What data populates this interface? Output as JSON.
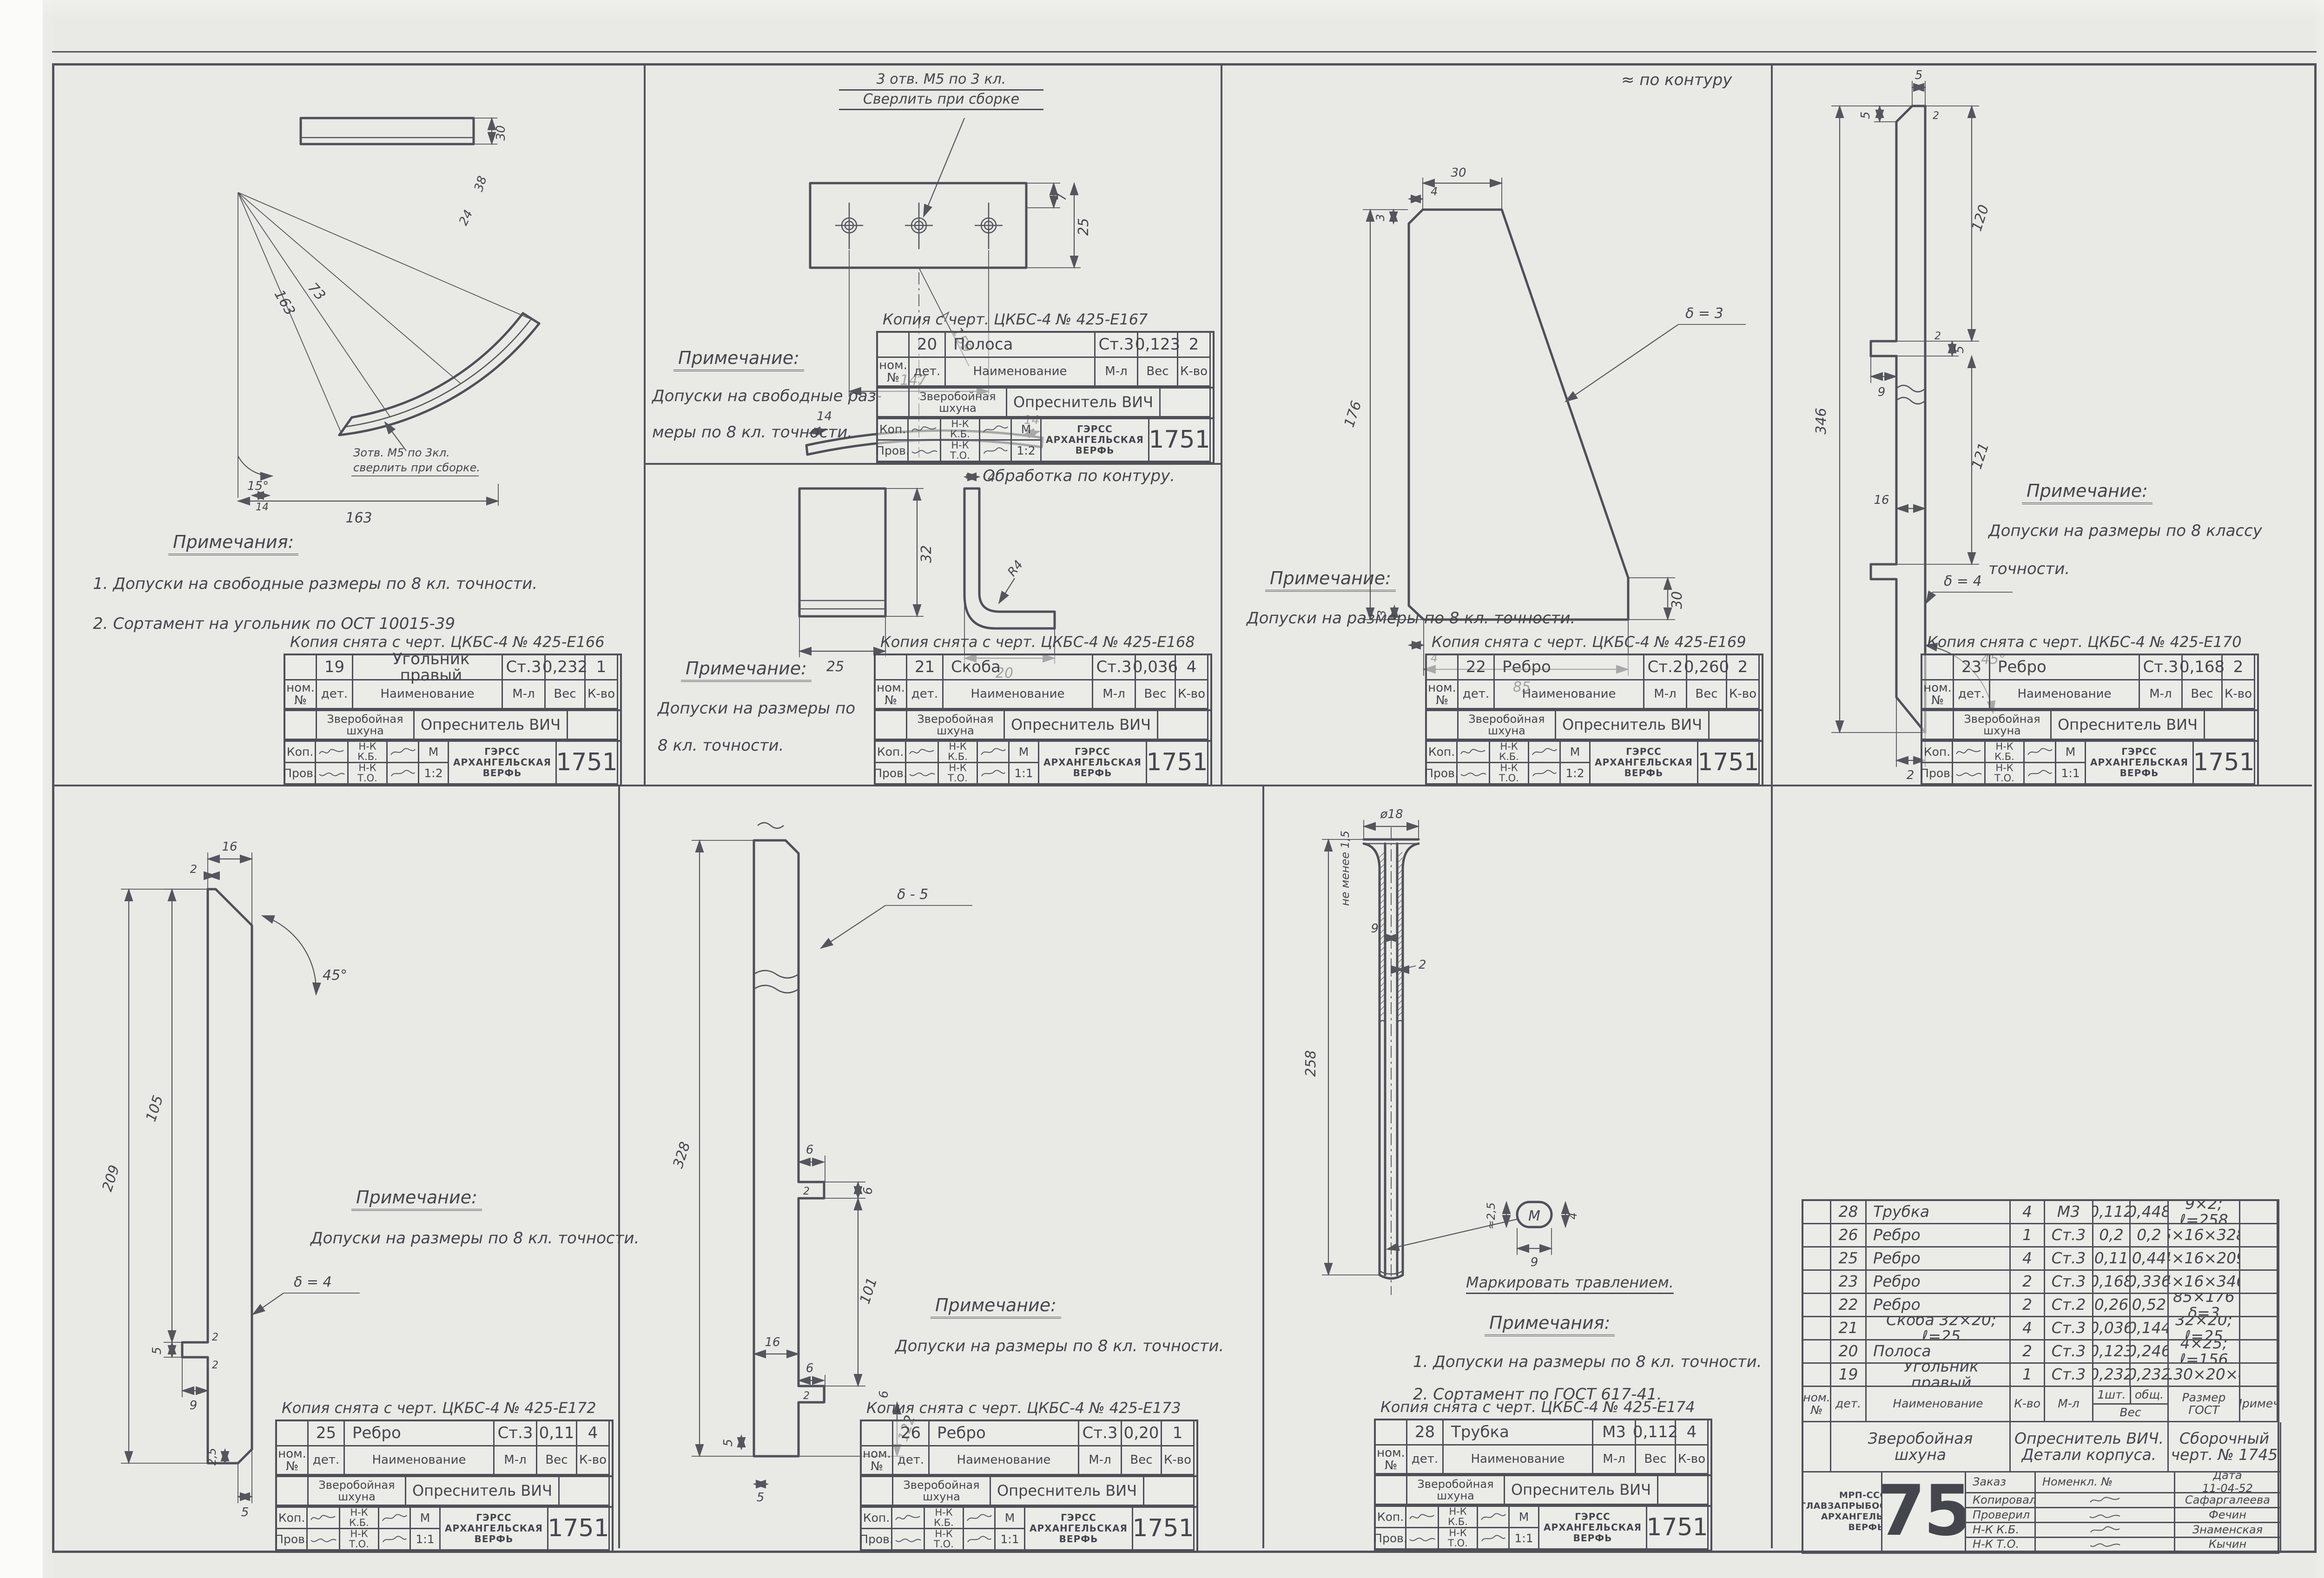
{
  "sheet": {
    "number": "1751",
    "contour_note_p22": "≈ по контуру",
    "contour_note_p20": "≈ Обработка по контуру."
  },
  "colors": {
    "paper": "#e9e9e6",
    "ink": "#4f5057"
  },
  "tb": {
    "nom": "ном.\n№",
    "det": "дет.",
    "name": "Наименование",
    "mat": "М-л",
    "weight": "Вес",
    "qty": "К-во",
    "project": "Зверобойная\nшхуна",
    "object": "Опреснитель ВИЧ",
    "kop": "Коп.",
    "prov": "Пров.",
    "nkkb": "Н-К\nК.Б.",
    "nkto": "Н-К\nТ.О.",
    "m": "М",
    "f1": "ГЭРСС",
    "f2": "АРХАНГЕЛЬСКАЯ",
    "f3": "ВЕРФЬ",
    "num": "1751"
  },
  "panels": {
    "p19": {
      "copy": "Копия снята с черт. ЦКБС-4 № 425-Е166",
      "num": "19",
      "name": "Угольник правый",
      "mat": "Ст.3",
      "weight": "0,232",
      "qty": "1",
      "scale": "1:2",
      "note_title": "Примечания:",
      "l1": "1. Допуски на свободные размеры  по 8 кл. точности.",
      "l2": "2. Сортамент на угольник  по ОСТ 10015-39",
      "labels": {
        "note1": "Зотв. М5 по 3кл.",
        "note2": "сверлить при сборке."
      },
      "dims": [
        "30",
        "38",
        "24",
        "163",
        "73",
        "15°",
        "163",
        "14"
      ]
    },
    "p20": {
      "copy": "Копия с черт. ЦКБС-4 № 425-Е167",
      "num": "20",
      "name": "Полоса",
      "mat": "Ст.3",
      "weight": "0,123",
      "qty": "2",
      "scale": "1:2",
      "note_title": "Примечание:",
      "l1": "Допуски на свободные раз-",
      "l2": "меры  по 8 кл. точности.",
      "labels": {
        "drill1": "3 отв. М5 по 3 кл.",
        "drill2": "Сверлить при сборке"
      },
      "dims": [
        "7",
        "25",
        "159",
        "147",
        "14",
        "14"
      ]
    },
    "p21": {
      "copy": "Копия снята с черт. ЦКБС-4 № 425-Е168",
      "num": "21",
      "name": "Скоба",
      "mat": "Ст.3",
      "weight": "0,036",
      "qty": "4",
      "scale": "1:1",
      "note_title": "Примечание:",
      "l1": "Допуски на размеры по",
      "l2": "8 кл. точности.",
      "dims": [
        "32",
        "25",
        "4",
        "R4",
        "20"
      ]
    },
    "p22": {
      "copy": "Копия снята с черт. ЦКБС-4 № 425-Е169",
      "num": "22",
      "name": "Ребро",
      "mat": "Ст.2",
      "weight": "0,260",
      "qty": "2",
      "scale": "1:2",
      "note_title": "Примечание:",
      "l1": "Допуски на размеры по 8 кл. точности.",
      "labels": {
        "delta": "δ = 3"
      },
      "dims": [
        "30",
        "4",
        "3",
        "176",
        "30",
        "85",
        "4",
        "3"
      ]
    },
    "p23": {
      "copy": "Копия снята с черт. ЦКБС-4 № 425-Е170",
      "num": "23",
      "name": "Ребро",
      "mat": "Ст.3",
      "weight": "0,168",
      "qty": "2",
      "scale": "1:1",
      "note_title": "Примечание:",
      "l1": "Допуски на размеры по 8 классу",
      "l2": "точности.",
      "labels": {
        "delta": "δ = 4"
      },
      "dims": [
        "5",
        "5",
        "2",
        "120",
        "346",
        "9",
        "5",
        "121",
        "16",
        "45°",
        "2"
      ]
    },
    "p25": {
      "copy": "Копия снята с черт. ЦКБС-4 № 425-Е172",
      "num": "25",
      "name": "Ребро",
      "mat": "Ст.3",
      "weight": "0,11",
      "qty": "4",
      "scale": "1:1",
      "note_title": "Примечание:",
      "l1": "Допуски на размеры по 8 кл. точности.",
      "labels": {
        "delta": "δ = 4"
      },
      "dims": [
        "16",
        "2",
        "45°",
        "105",
        "209",
        "5",
        "9",
        "2,5",
        "5",
        "2",
        "2"
      ]
    },
    "p26": {
      "copy": "Копия снята с черт. ЦКБС-4 № 425-Е173",
      "num": "26",
      "name": "Ребро",
      "mat": "Ст.3",
      "weight": "0,20",
      "qty": "1",
      "scale": "1:1",
      "note_title": "Примечание:",
      "l1": "Допуски на размеры по 8 кл. точности.",
      "labels": {
        "delta": "δ - 5"
      },
      "dims": [
        "6",
        "2",
        "6",
        "16",
        "101",
        "6",
        "2",
        "6",
        "122",
        "5",
        "5",
        "328"
      ]
    },
    "p28": {
      "copy": "Копия снята с черт. ЦКБС-4 № 425-Е174",
      "num": "28",
      "name": "Трубка",
      "mat": "М3",
      "weight": "0,112",
      "qty": "4",
      "scale": "1:1",
      "note_title": "Примечания:",
      "l1": "1. Допуски на размеры по 8 кл. точности.",
      "l2": "2. Сортамент  по ГОСТ 617-41.",
      "labels": {
        "min": "не менее 1,5",
        "mark": "М",
        "etch": "Маркировать травлением."
      },
      "dims": [
        "ø18",
        "9",
        "2",
        "258",
        "≈2,5",
        "4",
        "9"
      ]
    }
  },
  "parts_table": {
    "header": {
      "nom": "ном.\n№",
      "det": "дет.",
      "name": "Наименование",
      "qty": "К-во",
      "mat": "М-л",
      "w1": "1шт.",
      "w2": "общ.",
      "wshared": "Вес",
      "size": "Размер\nГОСТ",
      "note": "Примеч."
    },
    "rows": [
      {
        "num": "28",
        "name": "Трубка",
        "qty": "4",
        "mat": "М3",
        "w1": "0,112",
        "w2": "0,448",
        "size": "9×2; ℓ=258",
        "note": ""
      },
      {
        "num": "26",
        "name": "Ребро",
        "qty": "1",
        "mat": "Ст.3",
        "w1": "0,2",
        "w2": "0,2",
        "size": "5×16×328",
        "note": ""
      },
      {
        "num": "25",
        "name": "Ребро",
        "qty": "4",
        "mat": "Ст.3",
        "w1": "0,11",
        "w2": "0,44",
        "size": "4×16×209",
        "note": ""
      },
      {
        "num": "23",
        "name": "Ребро",
        "qty": "2",
        "mat": "Ст.3",
        "w1": "0,168",
        "w2": "0,336",
        "size": "4×16×346",
        "note": ""
      },
      {
        "num": "22",
        "name": "Ребро",
        "qty": "2",
        "mat": "Ст.2",
        "w1": "0,26",
        "w2": "0,52",
        "size": "85×176 δ=3",
        "note": ""
      },
      {
        "num": "21",
        "name": "Скоба 32×20; ℓ=25",
        "qty": "4",
        "mat": "Ст.3",
        "w1": "0,036",
        "w2": "0,144",
        "size": "32×20; ℓ=25",
        "note": ""
      },
      {
        "num": "20",
        "name": "Полоса",
        "qty": "2",
        "mat": "Ст.3",
        "w1": "0,123",
        "w2": "0,246",
        "size": "4×25; ℓ=156",
        "note": ""
      },
      {
        "num": "19",
        "name": "Угольник правый",
        "qty": "1",
        "mat": "Ст.3",
        "w1": "0,232",
        "w2": "0,232",
        "size": "∠30×20×4",
        "note": ""
      }
    ],
    "title": {
      "project": "Зверобойная\nшхуна",
      "object": "Опреснитель ВИЧ.\nДетали корпуса.",
      "drawing": "Сборочный\nчерт. № 1745"
    },
    "bottom": {
      "order": "Заказ",
      "nomenkl": "Номенкл. №",
      "date_label": "Дата",
      "date": "11-04-52",
      "org1": "МРП-СССР",
      "org2": "ГЛАВЗАПРЫБОСУДОСТР.",
      "org3": "АРХАНГЕЛЬСКАЯ",
      "org4": "ВЕРФЬ",
      "big_number": "1751",
      "sig1_role": "Копировала",
      "sig1_name": "Сафаргалеева",
      "sig2_role": "Проверил",
      "sig2_name": "Фечин",
      "sig3_role": "Н-К К.Б.",
      "sig3_name": "Знаменская",
      "sig4_role": "Н-К Т.О.",
      "sig4_name": "Кычин"
    }
  }
}
